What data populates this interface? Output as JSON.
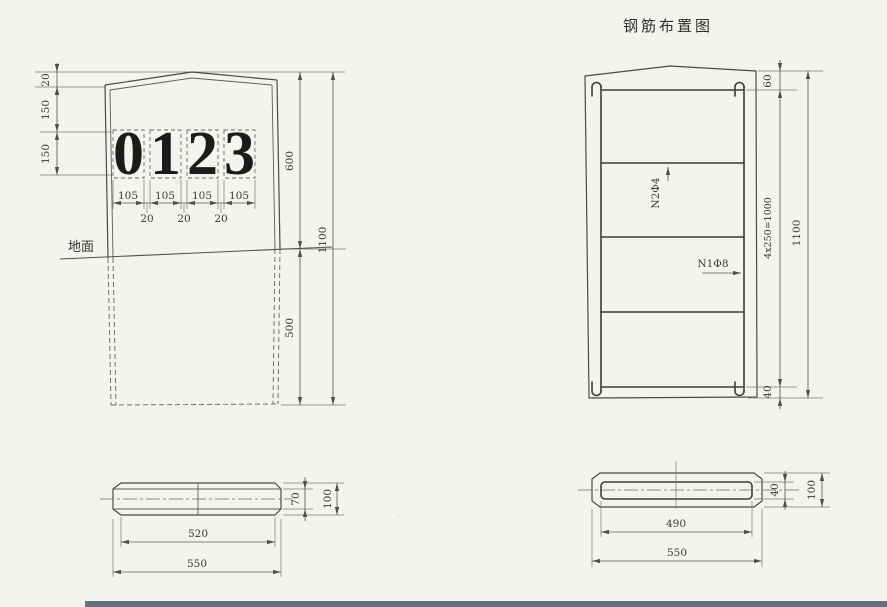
{
  "title": "钢筋布置图",
  "front_view": {
    "ground_label": "地面",
    "digits": [
      "0",
      "1",
      "2",
      "3"
    ],
    "dim_top": "20",
    "dim_row_upper": "150",
    "dim_row_lower": "150",
    "digit_widths": [
      "105",
      "105",
      "105",
      "105"
    ],
    "digit_gaps": [
      "20",
      "20",
      "20"
    ],
    "dim_above_ground": "600",
    "dim_below_ground": "500",
    "dim_total": "1100"
  },
  "front_section": {
    "dim_inner_h": "70",
    "dim_outer_h": "100",
    "dim_inner_w": "520",
    "dim_outer_w": "550"
  },
  "rebar_view": {
    "label_ties": "N2Φ4",
    "label_main": "N1Φ8",
    "dim_top": "60",
    "dim_spacing": "4x250=1000",
    "dim_total": "1100",
    "dim_bottom": "40"
  },
  "rebar_section": {
    "dim_inner_h": "40",
    "dim_outer_h": "100",
    "dim_inner_w": "490",
    "dim_outer_w": "550"
  },
  "colors": {
    "paper": "#f4f3ee",
    "line": "#4a4a4a",
    "scan_strip": "#68727f"
  }
}
